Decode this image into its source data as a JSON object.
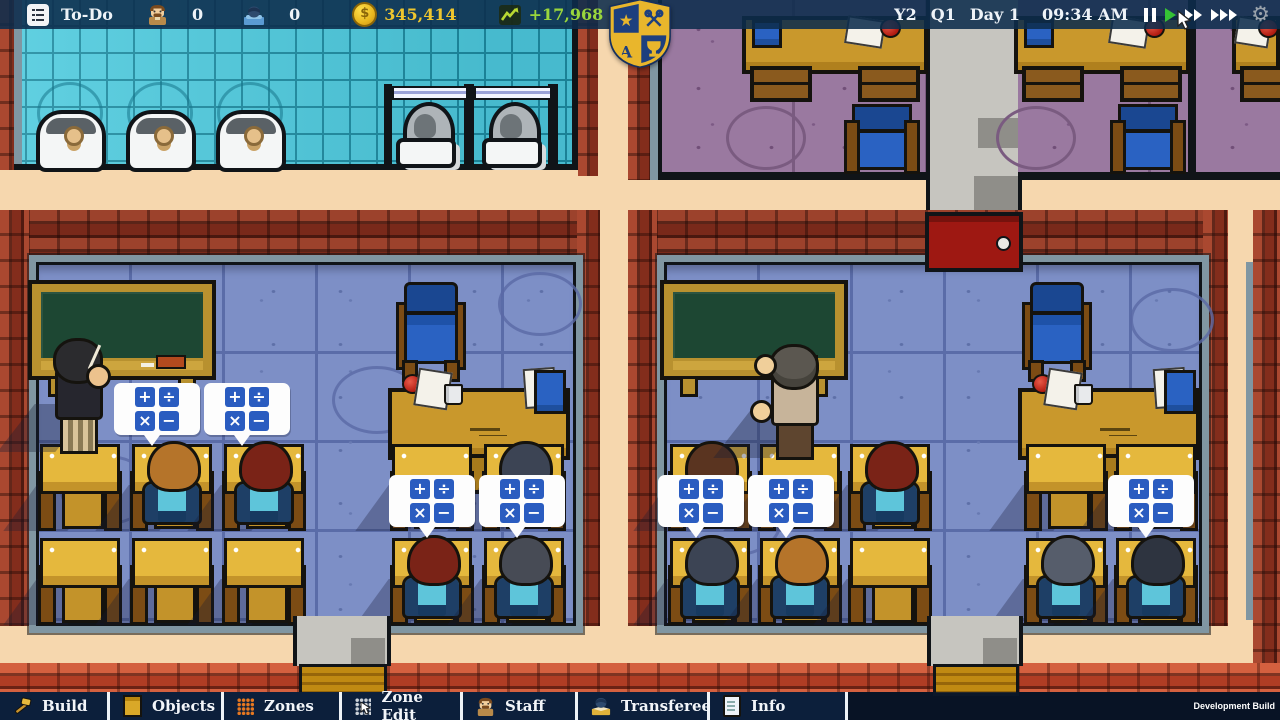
{
  "topbar": {
    "todo_label": "To-Do",
    "teacher_count": "0",
    "student_count": "0",
    "coin_symbol": "$",
    "money": "345,414",
    "money_delta": "+17,968",
    "year": "Y2",
    "quarter": "Q1",
    "day": "Day 1",
    "time": "09:34 AM",
    "icons": [
      "todo-list-icon",
      "teacher-count-icon",
      "student-count-icon",
      "coin-icon",
      "trend-chart-icon",
      "pause-icon",
      "play-icon",
      "fast-forward-icon",
      "fastest-forward-icon",
      "gear-icon"
    ],
    "active_speed": "play"
  },
  "crest": {
    "icon": "school-crest-shield"
  },
  "bubble": {
    "symbols": [
      "+",
      "÷",
      "×",
      "−"
    ]
  },
  "bottombar": {
    "tabs": [
      {
        "label": "Build",
        "icon": "hammer-icon"
      },
      {
        "label": "Objects",
        "icon": "cabinet-icon"
      },
      {
        "label": "Zones",
        "icon": "zone-grid-icon"
      },
      {
        "label": "Zone Edit",
        "icon": "zone-edit-grid-cursor-icon"
      },
      {
        "label": "Staff",
        "icon": "staff-person-icon"
      },
      {
        "label": "Transferee",
        "icon": "transferee-student-icon"
      },
      {
        "label": "Info",
        "icon": "info-document-icon"
      }
    ],
    "dev_build_label": "Development Build"
  },
  "colors": {
    "money_text": "#eec62e",
    "delta_text": "#9ad63c",
    "corridor": "#f6d7ae",
    "bathroom_tile": "#4fcbde",
    "classroom_floor": "#7d8fc6",
    "purple_floor": "#9a79a0",
    "chalkboard": "#1d4733",
    "bubble_blue": "#2a5cc0",
    "door_red": "#9e1812"
  },
  "scene": {
    "students": [
      {
        "desk": "L-r1c2",
        "hair": "#b5742a"
      },
      {
        "desk": "L-r1c3",
        "hair": "#7a2317"
      },
      {
        "desk": "L-r1c5",
        "hair": "#3c4454"
      },
      {
        "desk": "L-r2c4",
        "hair": "#7a2317"
      },
      {
        "desk": "L-r2c5",
        "hair": "#474b55"
      },
      {
        "desk": "R-r1c1",
        "hair": "#5a3420"
      },
      {
        "desk": "R-r1c3",
        "hair": "#7a2317"
      },
      {
        "desk": "R-r2c1",
        "hair": "#3c4454"
      },
      {
        "desk": "R-r2c2",
        "hair": "#b5742a"
      },
      {
        "desk": "R-r2c4",
        "hair": "#565d6b"
      },
      {
        "desk": "R-r2c5",
        "hair": "#2e3440"
      }
    ],
    "teachers": [
      {
        "room": "left",
        "hair": "#2b2b2e"
      },
      {
        "room": "right",
        "hair": "#5b5750"
      }
    ]
  }
}
